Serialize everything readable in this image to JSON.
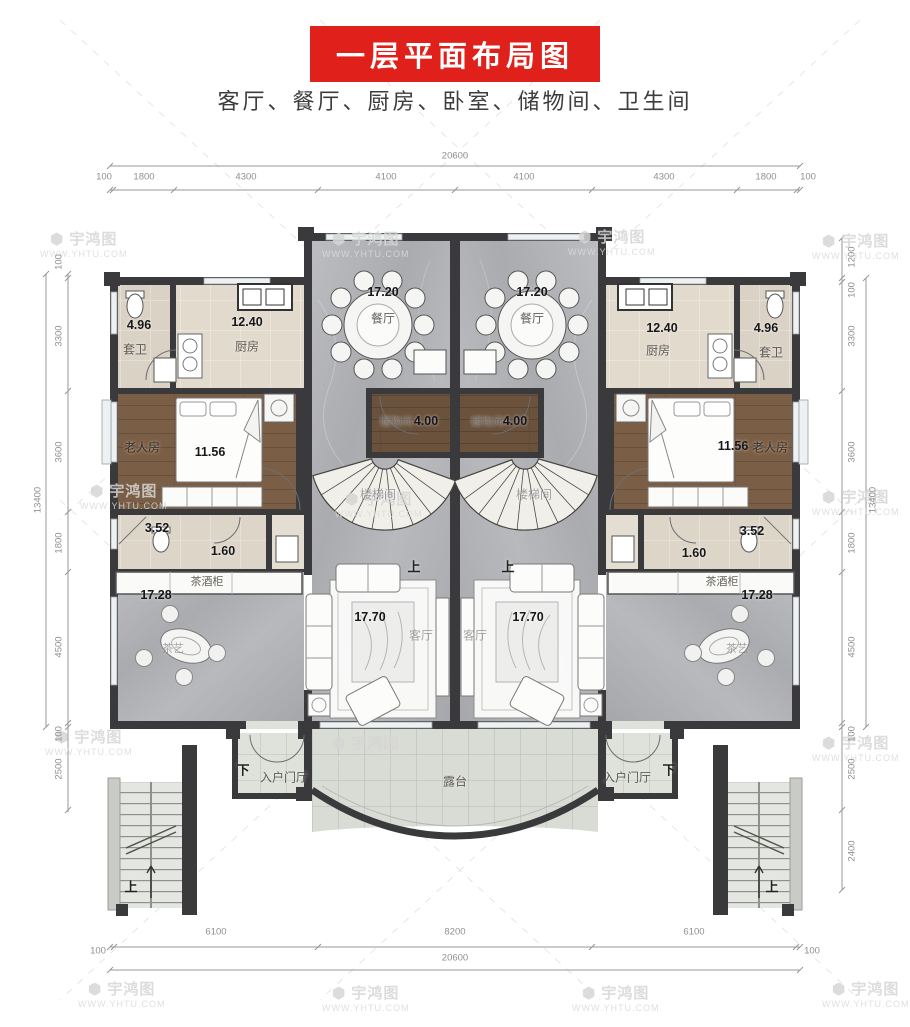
{
  "title": "一层平面布局图",
  "subtitle": "客厅、餐厅、厨房、卧室、储物间、卫生间",
  "watermark": {
    "logo": "⬢",
    "brand": "宇鸿图",
    "site": "WWW.YHTU.COM"
  },
  "dims": {
    "top_total": "20600",
    "top": [
      "100",
      "1800",
      "4300",
      "4100",
      "4100",
      "4300",
      "1800",
      "100"
    ],
    "bottom": [
      "100",
      "6100",
      "8200",
      "6100",
      "100"
    ],
    "bottom_total": "20600",
    "left_total": "13400",
    "left": [
      "100",
      "3300",
      "3600",
      "1800",
      "4500",
      "100",
      "2500"
    ],
    "right": [
      "1200",
      "100",
      "3300",
      "3600",
      "1800",
      "4500",
      "100",
      "2500",
      "2400"
    ],
    "right_total": "13400"
  },
  "rooms": {
    "dining": {
      "name": "餐厅",
      "area": "17.20"
    },
    "kitchen": {
      "name": "厨房",
      "area": "12.40"
    },
    "ensuite": {
      "name": "套卫",
      "area": "4.96"
    },
    "elder": {
      "name": "老人房",
      "area": "11.56"
    },
    "storage": {
      "name": "储物间",
      "area": "4.00"
    },
    "stairwell": {
      "name": "楼梯间"
    },
    "bath": {
      "area": "3.52"
    },
    "closet": {
      "area": "1.60"
    },
    "teacabinet": {
      "name": "茶酒柜",
      "area": "17.28"
    },
    "living": {
      "name": "客厅",
      "area": "17.70"
    },
    "teaart": {
      "name": "茶艺"
    },
    "foyer": {
      "name": "入户门厅"
    },
    "terrace": {
      "name": "露台"
    }
  },
  "labels": {
    "up": "上",
    "down": "下"
  }
}
